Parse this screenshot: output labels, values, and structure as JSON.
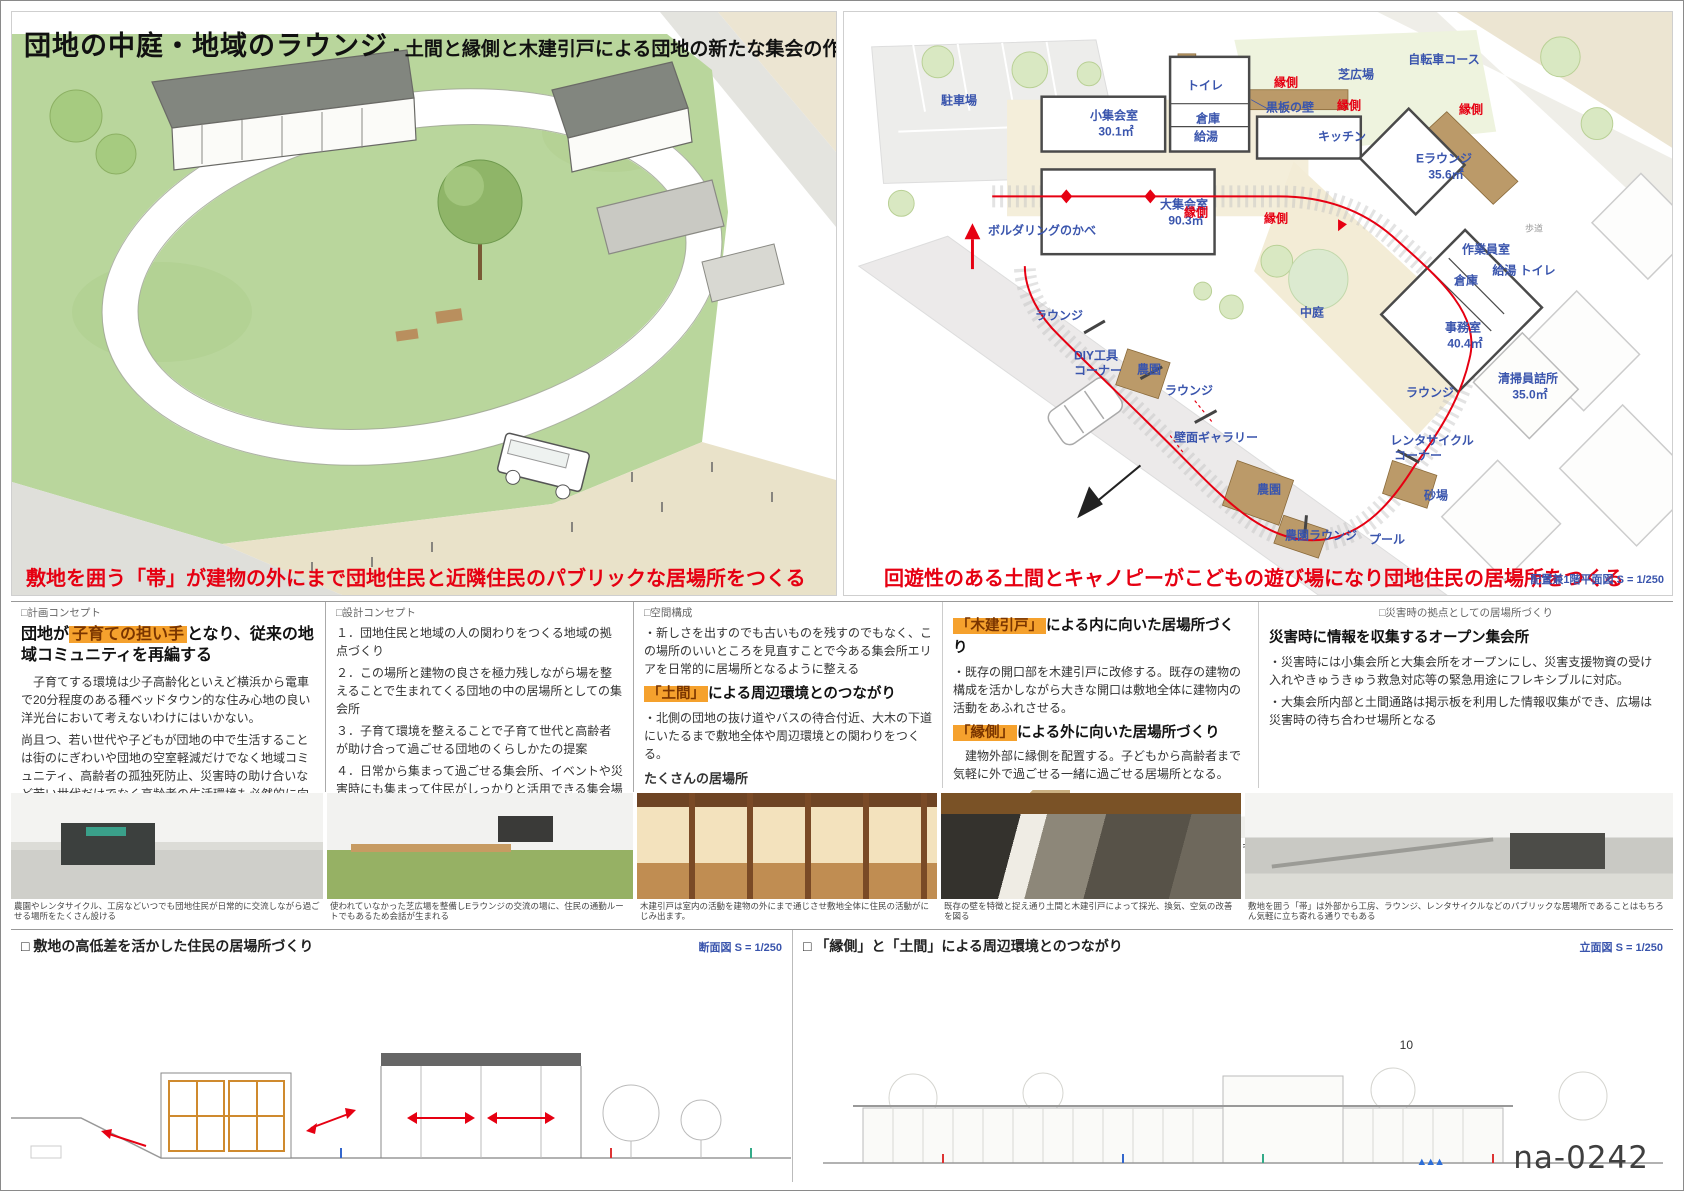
{
  "title": {
    "main": "団地の中庭・地域のラウンジ",
    "subtitle": " - 土間と縁側と木建引戸による団地の新たな集会の作法 -"
  },
  "left_panel": {
    "caption": "敷地を囲う「帯」が建物の外にまで団地住民と近隣住民のパブリックな居場所をつくる"
  },
  "site_plan": {
    "caption": "回遊性のある土間とキャノピーがこどもの遊び場になり団地住民の居場所をつくる",
    "scale_note": "配置兼1階平面図 S = 1/250",
    "red_label": "縁側",
    "labels": [
      "駐車場",
      "自転車コース",
      "トイレ",
      "小集会室",
      "30.1㎡",
      "倉庫",
      "給湯",
      "黒板の壁",
      "キッチン",
      "芝広場",
      "Eラウンジ",
      "35.6㎡",
      "大集会室",
      "90.3㎡",
      "ボルダリングのかべ",
      "中庭",
      "作業員室",
      "給湯 トイレ",
      "倉庫",
      "事務室",
      "40.4㎡",
      "清掃員詰所",
      "35.0㎡",
      "ラウンジ",
      "ラウンジ",
      "DIY工具",
      "コーナー",
      "農園",
      "ラウンジ",
      "壁面ギャラリー",
      "農園",
      "農園ラウンジ",
      "プール",
      "砂場",
      "レンタサイクル",
      "コーナー",
      "歩道"
    ]
  },
  "concepts": {
    "plan": {
      "tag": "□計画コンセプト",
      "h_pre": "団地が",
      "h_hl": "子育ての担い手",
      "h_post": "となり、従来の地域コミュニティを再編する",
      "body1": "　子育てする環境は少子高齢化といえど横浜から電車で20分程度のある種ベッドタウン的な住み心地の良い洋光台において考えないわけにはいかない。",
      "body2": "尚且つ、若い世代や子どもが団地の中で生活することは街のにぎわいや団地の空室軽減だけでなく地域コミュニティ、高齢者の孤独死防止、災害時の助け合いなど若い世代だけでなく高齢者の生活環境も必然的に向上していくことを想定している。",
      "sub_heading": "団地住民の中庭 / 周辺住民のラウンジ",
      "sub_note": "団地住民はもちろん周辺住民も使えるオープンな居場所"
    },
    "design": {
      "tag": "□設計コンセプト",
      "item1": "１．団地住民と地域の人の関わりをつくる地域の拠点づくり",
      "item2": "２．この場所と建物の良さを極力残しながら場を整えることで生まれてくる団地の中の居場所としての集会所",
      "item3": "３．子育て環境を整えることで子育て世代と高齢者が助け合って過ごせる団地のくらしかたの提案",
      "item4": "４．日常から集まって過ごせる集会所、イベントや災害時にも集まって住民がしっかりと活用できる集会場づくり",
      "sub_heading": "行為をつなぐ帯",
      "sub_note": "行為が敷地を囲い帯の内外からその行為を見渡すことができる"
    },
    "spatial": {
      "tag": "□空間構成",
      "bullet1": "・新しさを出すのでも古いものを残すのでもなく、この場所のいいところを見直すことで今ある集会所エリアを日常的に居場所となるように整える",
      "h_hl": "「土間」",
      "h_rest": "による周辺環境とのつながり",
      "bullet2": "・北側の団地の抜け道やバスの待合付近、大木の下道にいたるまで敷地全体や周辺環境との関わりをつくる。",
      "sub": "たくさんの居場所"
    },
    "doors": {
      "h1_hl": "「木建引戸」",
      "h1_rest": "による内に向いた居場所づくり",
      "body1": "・既存の開口部を木建引戸に改修する。既存の建物の構成を活かしながら大きな開口は敷地全体に建物内の活動をあふれさせる。",
      "h2_hl": "「縁側」",
      "h2_rest": "による外に向いた居場所づくり",
      "body2": "　建物外部に縁側を配置する。子どもから高齢者まで気軽に外で過ごせる一緒に過ごせる居場所となる。"
    },
    "disaster": {
      "tag": "□災害時の拠点としての居場所づくり",
      "heading": "災害時に情報を収集するオープン集会所",
      "bullet1": "・災害時には小集会所と大集会所をオープンにし、災害支援物資の受け入れやきゅうきゅう救急対応等の緊急用途にフレキシブルに対応。",
      "bullet2": "・大集会所内部と土間通路は掲示板を利用した情報収集ができ、広場は災害時の待ち合わせ場所となる"
    }
  },
  "sketch_row": {
    "items": [
      "団地の裏通と会話が生まれる縁側",
      "バスの待合所にもなる屋外ラウンジ",
      "屋外階段がイベント時の客席に",
      "芝広場でピクニック",
      "キッチンで料理をして外でBBQ",
      "通り土間はこどもの遊び場になる",
      "庭のない住民も楽しめる農園"
    ]
  },
  "photo_row": {
    "captions": [
      "農園やレンタサイクル、工房などいつでも団地住民が日常的に交流しながら過ごせる場所をたくさん設ける",
      "使われていなかった芝広場を整備しEラウンジの交流の場に、住民の通勤ルートでもあるため会話が生まれる",
      "木建引戸は室内の活動を建物の外にまで通じさせ敷地全体に住民の活動がにじみ出ます。",
      "既存の壁を特徴と捉え通り土間と木建引戸によって採光、換気、空気の改善を図る",
      "敷地を囲う「帯」は外部から工房、ラウンジ、レンタサイクルなどのパブリックな居場所であることはもちろん気軽に立ち寄れる通りでもある"
    ]
  },
  "bottom": {
    "left": {
      "heading": "□ 敷地の高低差を活かした住民の居場所づくり",
      "scale": "断面図 S = 1/250"
    },
    "right": {
      "heading": "□ 「縁側」と「土間」による周辺環境とのつながり",
      "scale": "立面図 S = 1/250",
      "page": "10"
    }
  },
  "watermark": "na-0242",
  "colors": {
    "accent_red": "#e60012",
    "label_blue": "#3a55ad",
    "highlight_orange": "#f5a12d",
    "title_green": "#b5d69a"
  }
}
